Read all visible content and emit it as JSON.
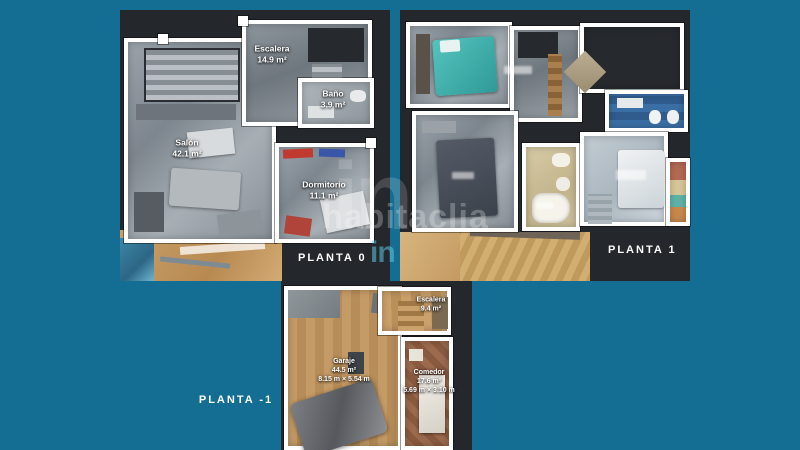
{
  "collage": {
    "background": "#146E93",
    "panel_background": "#24272B",
    "wall_color": "#FFFFFF",
    "title_color": "#FFFFFF"
  },
  "watermark": {
    "logo": "in",
    "text": "habitaclia"
  },
  "floors": [
    {
      "title": "PLANTA 0",
      "rooms": [
        {
          "name": "Escalera",
          "area": "14.9 m²"
        },
        {
          "name": "Baño",
          "area": "3.9 m²"
        },
        {
          "name": "Salón",
          "area": "42.1 m²"
        },
        {
          "name": "Dormitorio",
          "area": "11.1 m²"
        }
      ]
    },
    {
      "title": "PLANTA 1",
      "rooms": []
    },
    {
      "title": "PLANTA -1",
      "rooms": [
        {
          "name": "Escalera",
          "area": "9.4 m²",
          "dims": ""
        },
        {
          "name": "Garaje",
          "area": "44.5 m²",
          "dims": "8.15 m × 5.54 m"
        },
        {
          "name": "Comedor",
          "area": "17.6 m²",
          "dims": "5.69 m × 3.10 m"
        }
      ]
    }
  ]
}
